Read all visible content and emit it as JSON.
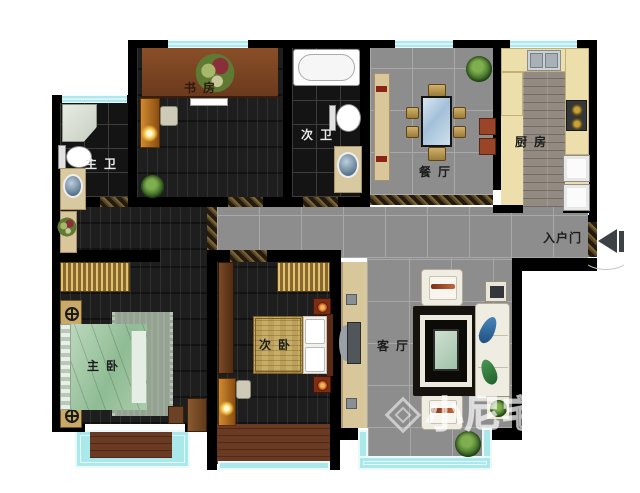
{
  "plan": {
    "rooms": {
      "study": {
        "label": "书 房"
      },
      "second_bath": {
        "label": "次 卫"
      },
      "master_bath": {
        "label": "主 卫"
      },
      "dining": {
        "label": "餐 厅"
      },
      "kitchen": {
        "label": "厨 房"
      },
      "entry": {
        "label": "入户门"
      },
      "master_bedroom": {
        "label": "主 卧"
      },
      "second_bedroom": {
        "label": "次 卧"
      },
      "living": {
        "label": "客 厅"
      }
    },
    "watermark": {
      "text": "小尼宅配"
    },
    "icons": {
      "entry_arrow": "left-filled-door-direction-arrow",
      "watermark_logo": "rotated-square-cube-logo"
    },
    "colors": {
      "wall": "#000000",
      "window_glass": "#b6edf2",
      "tile_gray": "#8d8d8d",
      "dark_wood_floor": "#1d1e1d",
      "balcony_wood": "#6b3a22",
      "kitchen_counter": "#ecdfab",
      "bath_tile": "#141414",
      "bed_green": "#9ec2a0",
      "wardrobe_gold": "#c9a85c",
      "quilt_gold": "#c6ae67",
      "sofa_cream": "#efece2"
    }
  }
}
